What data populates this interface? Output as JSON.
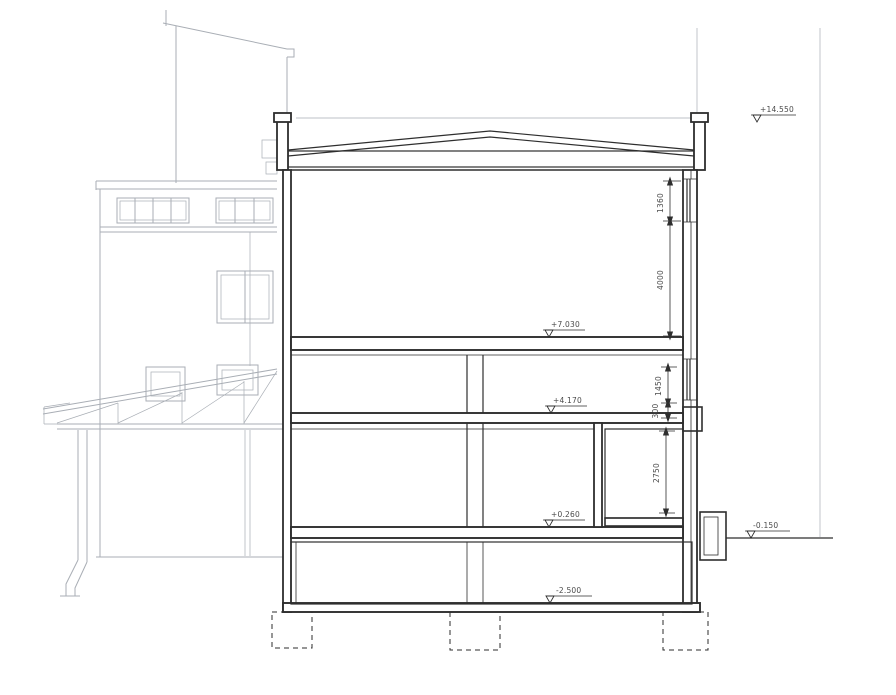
{
  "drawing": {
    "type": "architectural-building-cross-section",
    "labels": {
      "elev_parapet": "+14.550",
      "elev_hall_floor": "+7.030",
      "elev_second_floor": "+4.170",
      "elev_ground_floor": "+0.260",
      "elev_site_ground": "-0.150",
      "elev_basement_floor": "-2.500",
      "dim_hall_window": "1360",
      "dim_hall_height": "4000",
      "dim_floor2_window": "1450",
      "dim_floor2_slab": "300",
      "dim_ground_room": "2750"
    },
    "colors": {
      "ink": "#2e2e2e",
      "line_light": "#a9aeb5",
      "text": "#4b4b4b",
      "paper": "#ffffff"
    }
  }
}
